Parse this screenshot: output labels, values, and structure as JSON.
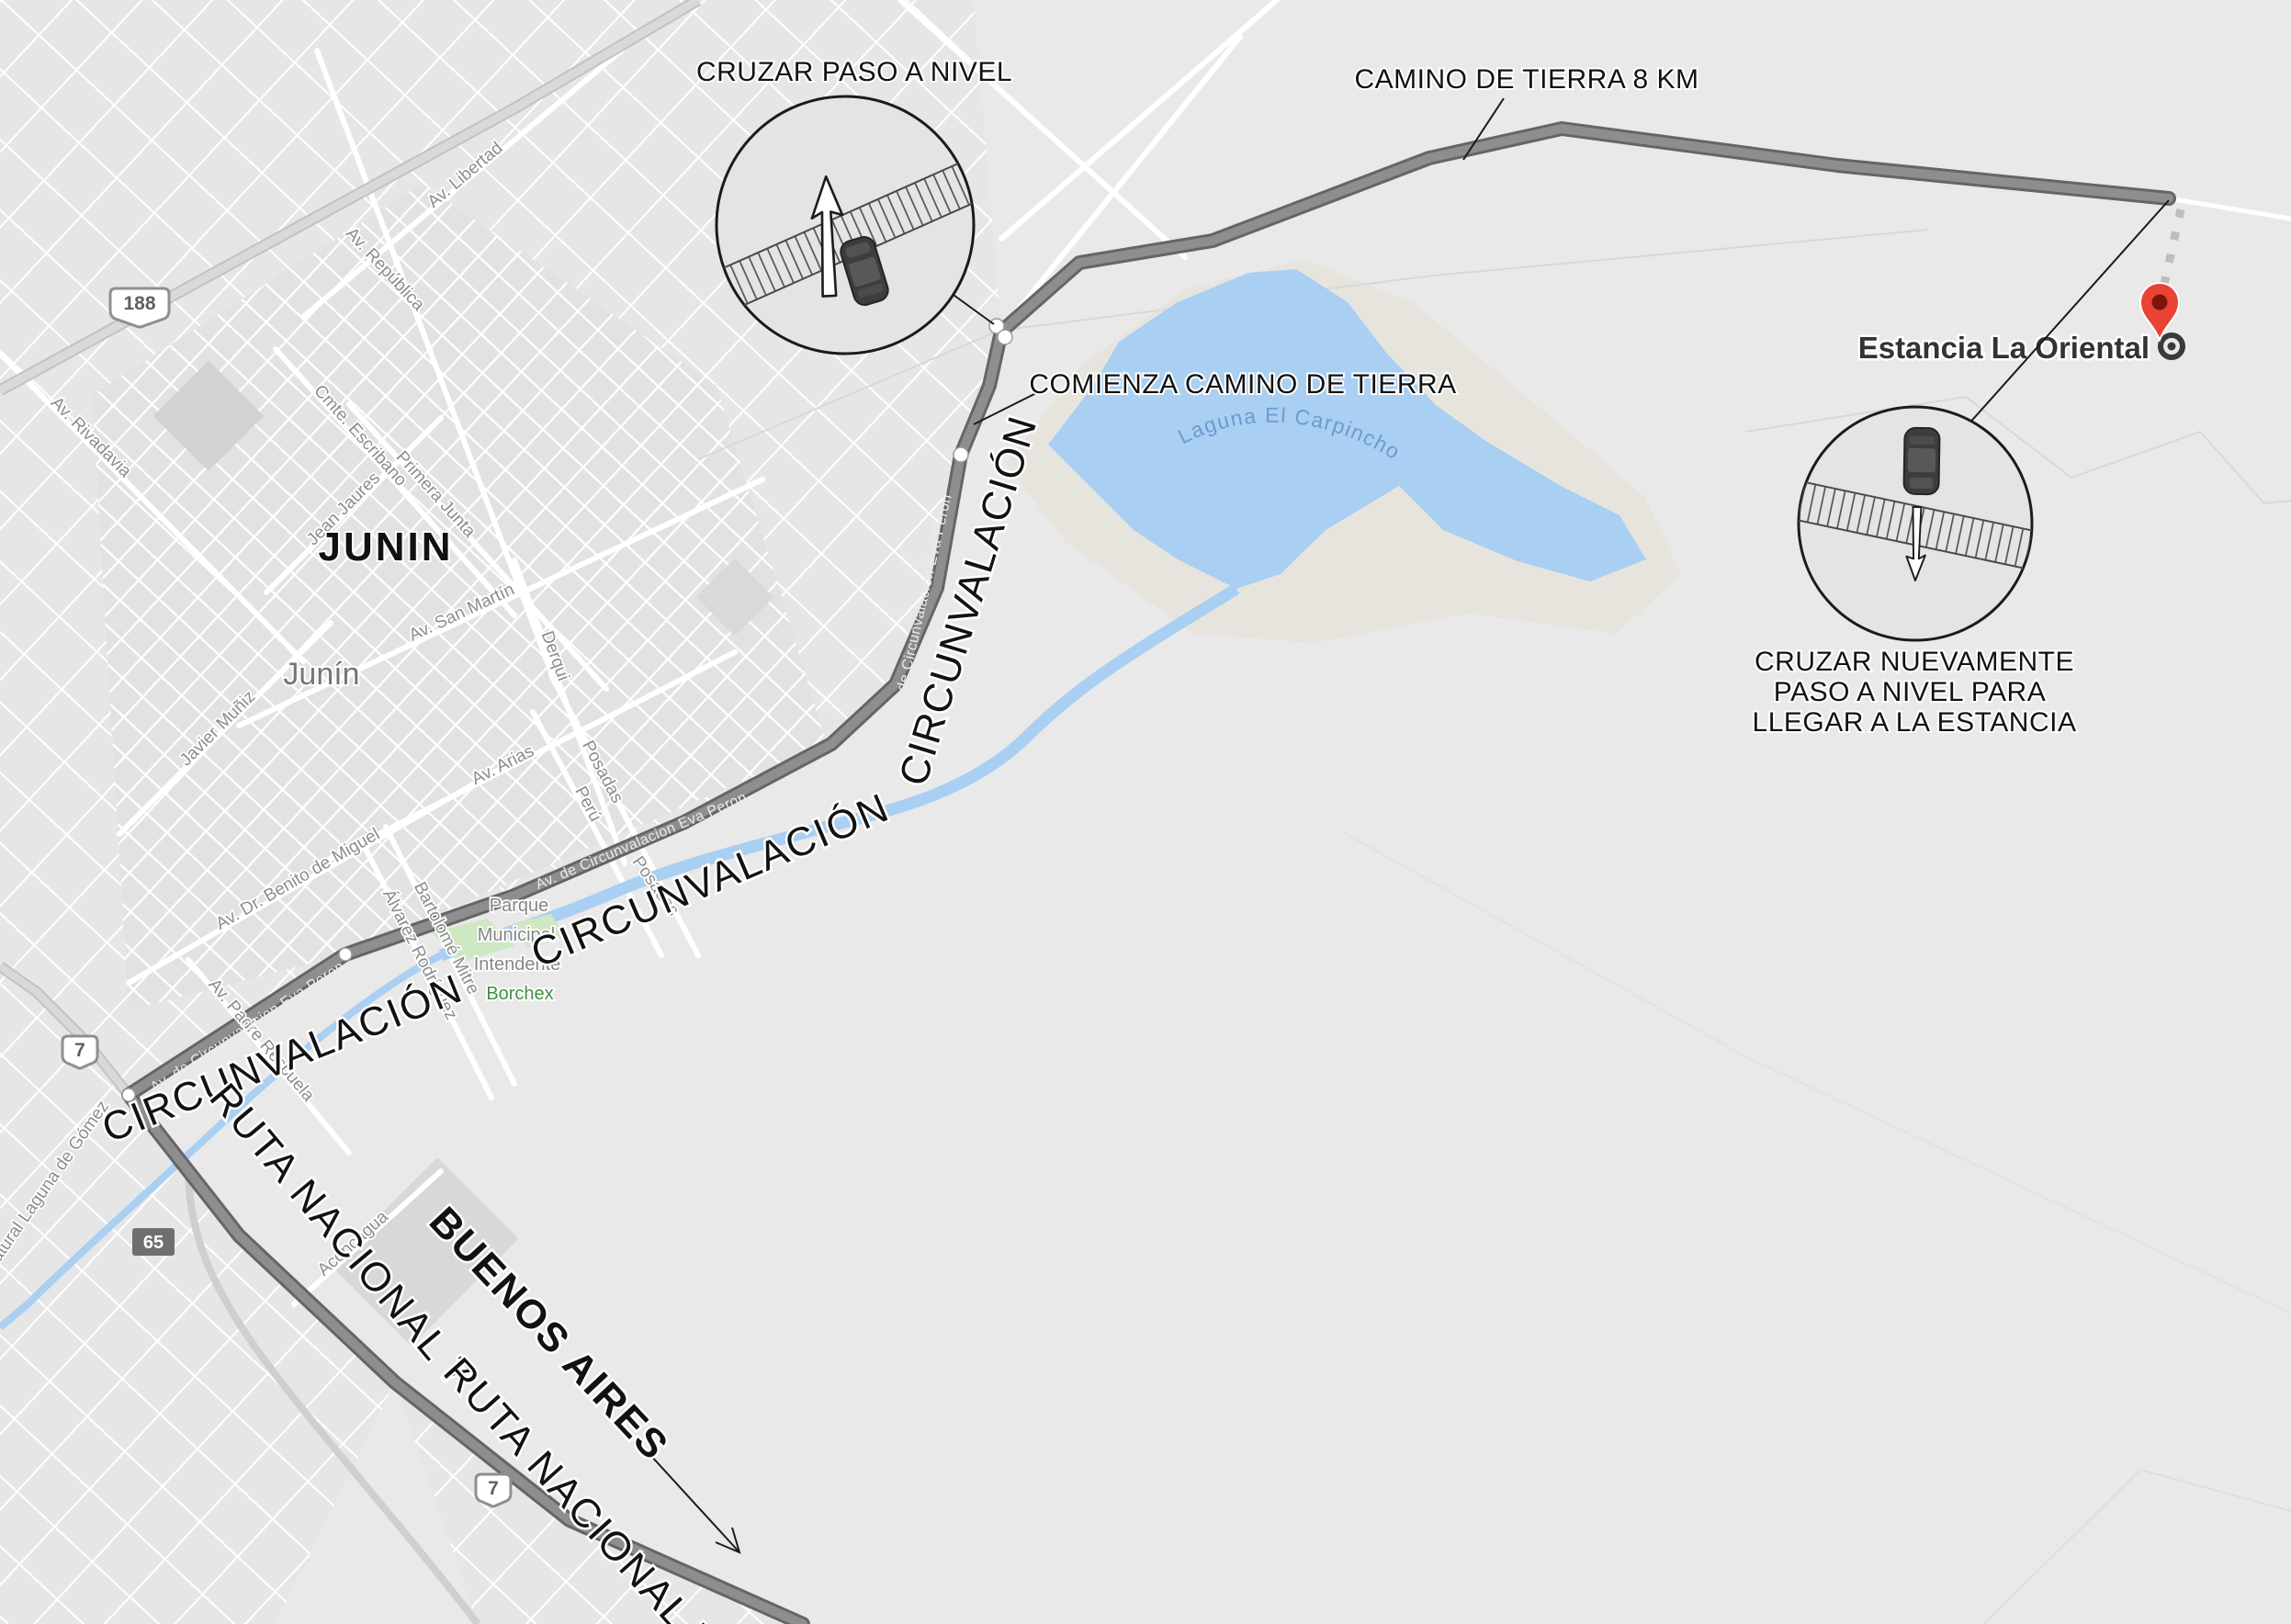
{
  "annotations": {
    "cruzar1": "CRUZAR PASO A NIVEL",
    "camino8": "CAMINO DE TIERRA 8 KM",
    "comienza": "COMIENZA CAMINO DE TIERRA",
    "cruzar2_l1": "CRUZAR NUEVAMENTE",
    "cruzar2_l2": "PASO A NIVEL PARA",
    "cruzar2_l3": "LLEGAR A LA ESTANCIA",
    "estancia": "Estancia La Oriental",
    "buenos_aires": "BUENOS AIRES",
    "ruta_nacional_7": "RUTA NACIONAL 7",
    "circunvalacion": "CIRCUNVALACIÓN"
  },
  "city": {
    "big": "JUNIN",
    "small": "Junín"
  },
  "lake": {
    "name": "Laguna El Carpincho"
  },
  "park": {
    "l1": "Parque",
    "l2": "Municipal",
    "l3": "Intendente",
    "l4": "Borchex"
  },
  "roads": {
    "eva_peron": "Av. de Circunvalacion Eva Peron"
  },
  "shields": {
    "r188": "188",
    "r7": "7",
    "r65": "65"
  },
  "streets": {
    "av_libertad": "Av. Libertad",
    "av_republica": "Av. República",
    "cmte_escribano": "Cmte. Escribano",
    "primera_junta": "Primera Junta",
    "av_rivadavia": "Av. Rivadavia",
    "jean_jaures": "Jean Jaures",
    "av_san_martin": "Av. San Martín",
    "derqui": "Derqui",
    "av_arias": "Av. Arias",
    "posadas": "Posadas",
    "peru": "Perú",
    "av_dr_benito_de_miguel": "Av. Dr. Benito de Miguel",
    "bartolome_mitre": "Bartolomé Mitre",
    "alvarez_rodriguez": "Álvarez Rodríguez",
    "javier_muniz": "Javier Muñiz",
    "av_padre_respuela": "Av. Padre Respuela",
    "aconcagua": "Aconcagua",
    "natural_laguna_de_gomez": "Natural Laguna de Gómez"
  },
  "colors": {
    "land": "#e9e9e9",
    "water": "#a9cff2",
    "water_label": "#6d9ad0",
    "route": "#8e8e8e",
    "route_casing": "#656565",
    "pin_red": "#e94335",
    "park_green": "#3f8f43",
    "street_label": "#8c8c8c",
    "annotation": "#121212"
  }
}
